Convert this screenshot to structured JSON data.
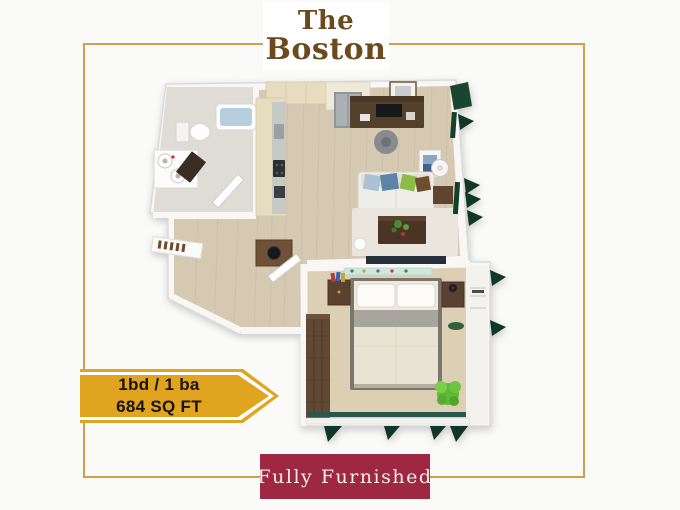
{
  "page": {
    "background": "#fafaf8"
  },
  "frame": {
    "border_color": "#d29e4b"
  },
  "title": {
    "line1": "The",
    "line2": "Boston",
    "text_color": "#6b4a1e"
  },
  "spec_banner": {
    "line1": "1bd / 1 ba",
    "line2": "684 SQ FT",
    "fill": "#e1a41f",
    "outline": "#ffffff",
    "text_color": "#161310"
  },
  "furnished_banner": {
    "label": "Fully Furnished",
    "fill": "#9e2742",
    "text_color": "#f4efe9"
  },
  "floor_plan": {
    "type": "3d-top-down-floor-plan-render",
    "rooms": [
      "bathroom",
      "kitchen",
      "hallway",
      "living-room",
      "bedroom"
    ],
    "palette": {
      "wall": "#f8f7f5",
      "wood_floor": "#d5c9b1",
      "carpet": "#dccfb4",
      "tile": "#dfdcd6",
      "cabinet_beige": "#e7dcc0",
      "dark_wood": "#5a4130",
      "window_green": "#11372a",
      "plant_green": "#61ba33",
      "sill_teal": "#2a564c",
      "sofa_blue_pillow": "#5b84a8",
      "sofa_green_pillow": "#8cbc45"
    }
  }
}
